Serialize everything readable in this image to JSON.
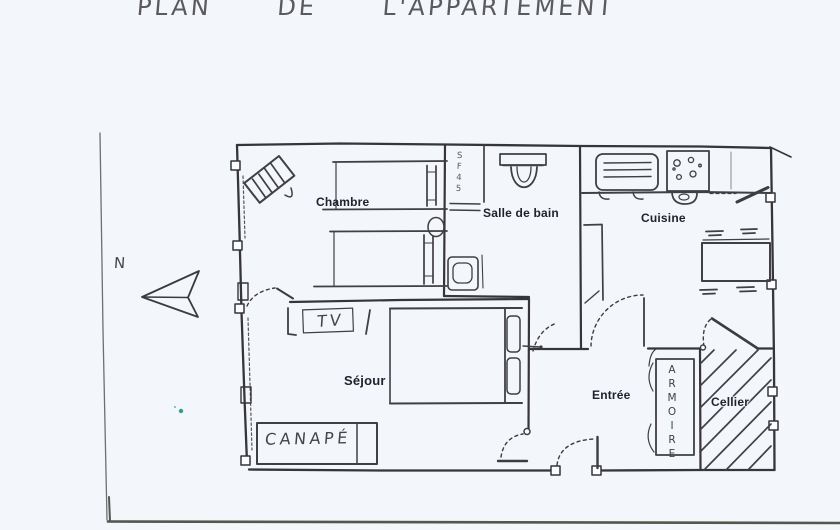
{
  "page": {
    "title": "PLAN DE L'APPARTEMENT",
    "background": "#f3f6fa",
    "ink_color": "#35353a",
    "label_color": "#22222c",
    "scan_edge_color": "#53574f",
    "speck_color": "#2da190"
  },
  "compass": {
    "north_label": "N"
  },
  "rooms": [
    {
      "id": "chambre",
      "label": "Chambre"
    },
    {
      "id": "salle_de_bain",
      "label": "Salle de bain"
    },
    {
      "id": "cuisine",
      "label": "Cuisine"
    },
    {
      "id": "sejour",
      "label": "Séjour"
    },
    {
      "id": "entree",
      "label": "Entrée"
    },
    {
      "id": "cellier",
      "label": "Cellier"
    }
  ],
  "furniture_labels": {
    "tv": "TV",
    "sofa": "CANAPÉ",
    "wardrobe": "ARMOIRE",
    "bath_note": "SF45"
  }
}
